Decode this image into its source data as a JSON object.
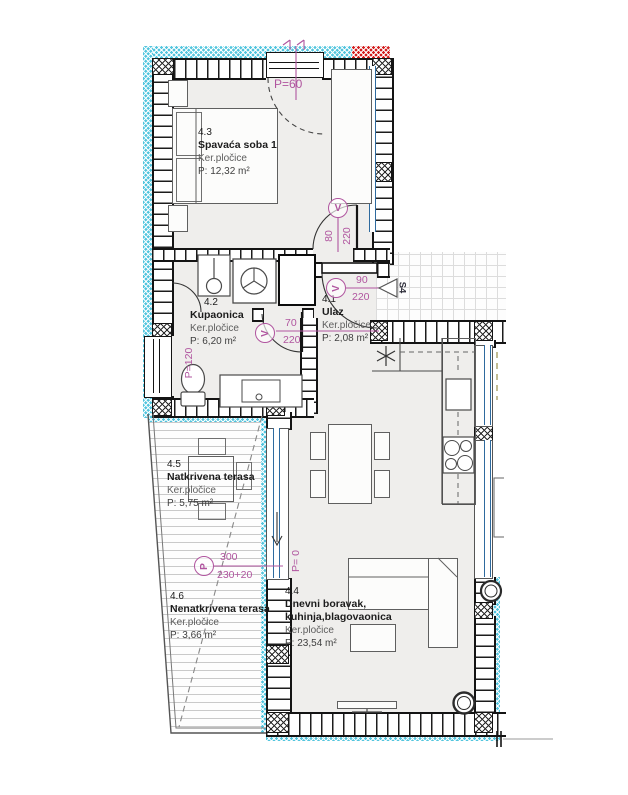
{
  "rooms": [
    {
      "id": "4.3",
      "name": "Spavaća soba 1",
      "finish": "Ker.pločice",
      "area": "P: 12,32 m²"
    },
    {
      "id": "4.2",
      "name": "Kupaonica",
      "finish": "Ker.pločice",
      "area": "P: 6,20 m²"
    },
    {
      "id": "4.1",
      "name": "Ulaz",
      "finish": "Ker.pločice",
      "area": "P: 2,08 m²"
    },
    {
      "id": "4.4",
      "name": "Dnevni boravak,",
      "name2": "kuhinja,blagovaonica",
      "finish": "Ker.pločice",
      "area": "P: 23,54 m²"
    },
    {
      "id": "4.5",
      "name": "Natkrivena terasa",
      "finish": "Ker.pločice",
      "area": "P: 5,75 m²"
    },
    {
      "id": "4.6",
      "name": "Nenatkrivena terasa",
      "finish": "Ker.pločice",
      "area": "P: 3,66 m²"
    }
  ],
  "dims": {
    "bedroom_window_parapet": "P=60",
    "bathroom_window_parapet": "P=120",
    "terrace_door_parapet": "P= 0",
    "door_symbol": "V",
    "parapet_symbol": "P",
    "bedroom_door_width": "80",
    "bedroom_door_height": "220",
    "bathroom_door_width": "70",
    "bathroom_door_height": "220",
    "entry_door_width": "90",
    "entry_door_height": "220",
    "entry_mark": "S4",
    "terrace_dim_top": "300",
    "terrace_dim_bottom": "230+20"
  },
  "colors": {
    "dimension": "#b0559f",
    "insulation": "#52c5de",
    "separation": "#d41f1f",
    "glazing": "#2e6a9e",
    "wall": "#141414",
    "floor": "#efeeec"
  }
}
